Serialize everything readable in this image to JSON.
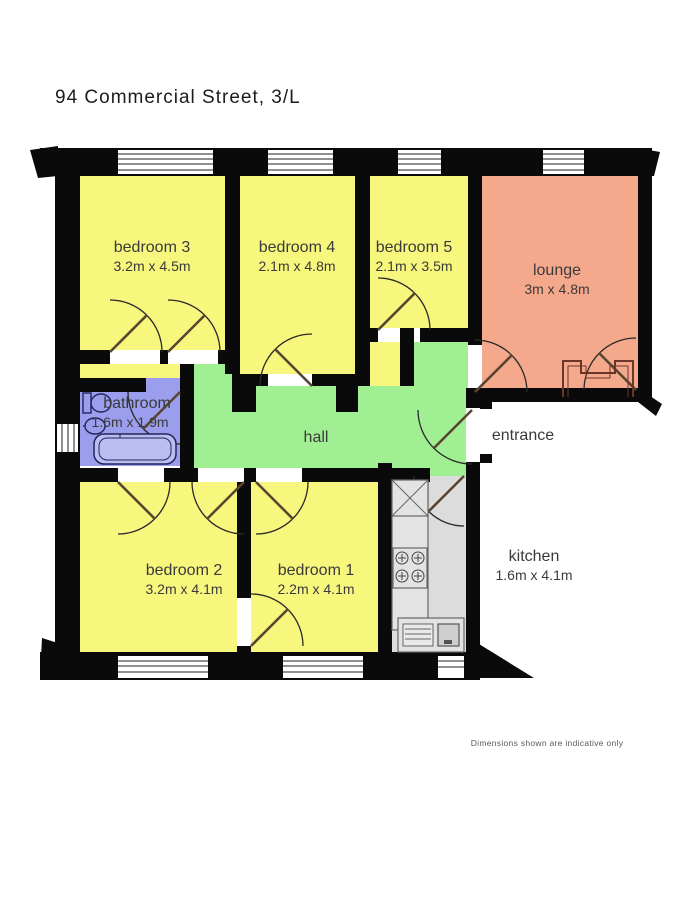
{
  "title": "94 Commercial Street, 3/L",
  "disclaimer": "Dimensions shown are indicative only",
  "rooms": {
    "bedroom3": {
      "name": "bedroom 3",
      "dims": "3.2m x 4.5m"
    },
    "bedroom4": {
      "name": "bedroom 4",
      "dims": "2.1m x 4.8m"
    },
    "bedroom5": {
      "name": "bedroom 5",
      "dims": "2.1m x 3.5m"
    },
    "lounge": {
      "name": "lounge",
      "dims": "3m x 4.8m"
    },
    "bathroom": {
      "name": "bathroom",
      "dims": "1.6m x 1.9m"
    },
    "hall": {
      "name": "hall"
    },
    "entrance": {
      "name": "entrance"
    },
    "bedroom2": {
      "name": "bedroom 2",
      "dims": "3.2m x 4.1m"
    },
    "bedroom1": {
      "name": "bedroom 1",
      "dims": "2.2m x 4.1m"
    },
    "kitchen": {
      "name": "kitchen",
      "dims": "1.6m x 4.1m"
    }
  },
  "colors": {
    "bedroom": "#f7f67d",
    "lounge": "#f5a98c",
    "hall": "#a0ef93",
    "bathroom": "#9b9ded",
    "kitchen": "#dcdcdc",
    "wall": "#0a0a0a",
    "bath_fixture": "#b9bdf2"
  }
}
